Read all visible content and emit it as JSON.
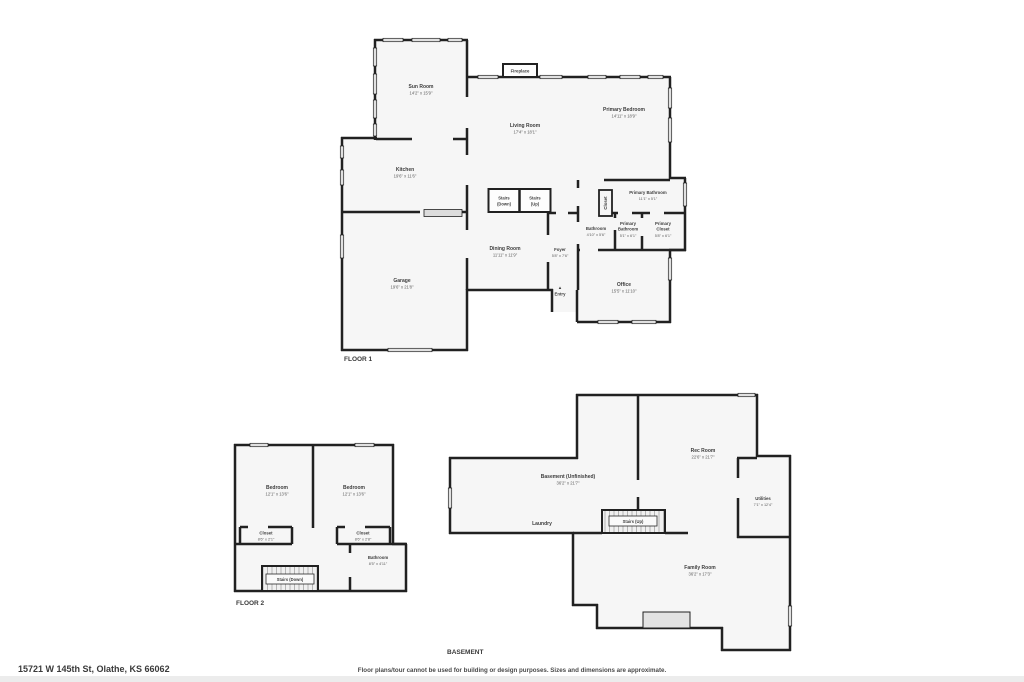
{
  "meta": {
    "address": "15721 W 145th St, Olathe, KS 66062",
    "disclaimer": "Floor plans/tour cannot be used for building or design purposes. Sizes and dimensions are approximate."
  },
  "floor1": {
    "title": "FLOOR 1",
    "rooms": {
      "sunroom": {
        "name": "Sun Room",
        "dims": "14'2\" x 15'9\""
      },
      "living": {
        "name": "Living Room",
        "dims": "17'4\" x 18'1\""
      },
      "primary_bedroom": {
        "name": "Primary Bedroom",
        "dims": "14'11\" x 18'9\""
      },
      "kitchen": {
        "name": "Kitchen",
        "dims": "19'6\" x 11'6\""
      },
      "dining": {
        "name": "Dining Room",
        "dims": "11'11\" x 11'9\""
      },
      "foyer": {
        "name": "Foyer",
        "dims": "5'8\" x 7'6\""
      },
      "garage": {
        "name": "Garage",
        "dims": "19'6\" x 21'8\""
      },
      "office": {
        "name": "Office",
        "dims": "15'5\" x 11'10\""
      },
      "primary_bathroom": {
        "name": "Primary Bathroom",
        "dims": "11'1\" x 5'1\""
      },
      "bathroom": {
        "name": "Bathroom",
        "dims": "4'10\" x 5'6\""
      },
      "primary_bathroom_2": {
        "name": "Primary",
        "name2": "Bathroom",
        "dims": "5'1\" x 6'1\""
      },
      "primary_closet": {
        "name": "Primary",
        "name2": "Closet",
        "dims": "5'8\" x 6'1\""
      },
      "closet": {
        "name": "Closet"
      },
      "stairs_down": {
        "name": "Stairs",
        "name2": "(Down)"
      },
      "stairs_up": {
        "name": "Stairs",
        "name2": "(Up)"
      },
      "fireplace": {
        "name": "Fireplace"
      },
      "entry": {
        "name": "Entry",
        "arrow": "▲"
      }
    }
  },
  "floor2": {
    "title": "FLOOR 2",
    "rooms": {
      "bedroom_left": {
        "name": "Bedroom",
        "dims": "12'1\" x 13'6\""
      },
      "bedroom_right": {
        "name": "Bedroom",
        "dims": "12'1\" x 13'6\""
      },
      "closet_left": {
        "name": "Closet",
        "dims": "8'6\" x 2'1\""
      },
      "closet_right": {
        "name": "Closet",
        "dims": "8'6\" x 2'8\""
      },
      "bathroom": {
        "name": "Bathroom",
        "dims": "8'5\" x 4'11\""
      },
      "stairs_down": {
        "name": "Stairs (Down)"
      }
    }
  },
  "basement": {
    "title": "BASEMENT",
    "rooms": {
      "unfinished": {
        "name": "Basement (Unfinished)",
        "dims": "36'2\" x 21'7\""
      },
      "rec_room": {
        "name": "Rec Room",
        "dims": "22'6\" x 21'7\""
      },
      "utilities": {
        "name": "Utilities",
        "dims": "7'1\" x 12'4\""
      },
      "laundry": {
        "name": "Laundry"
      },
      "stairs_up": {
        "name": "Stairs (Up)"
      },
      "family_room": {
        "name": "Family Room",
        "dims": "36'2\" x 17'3\""
      }
    }
  }
}
